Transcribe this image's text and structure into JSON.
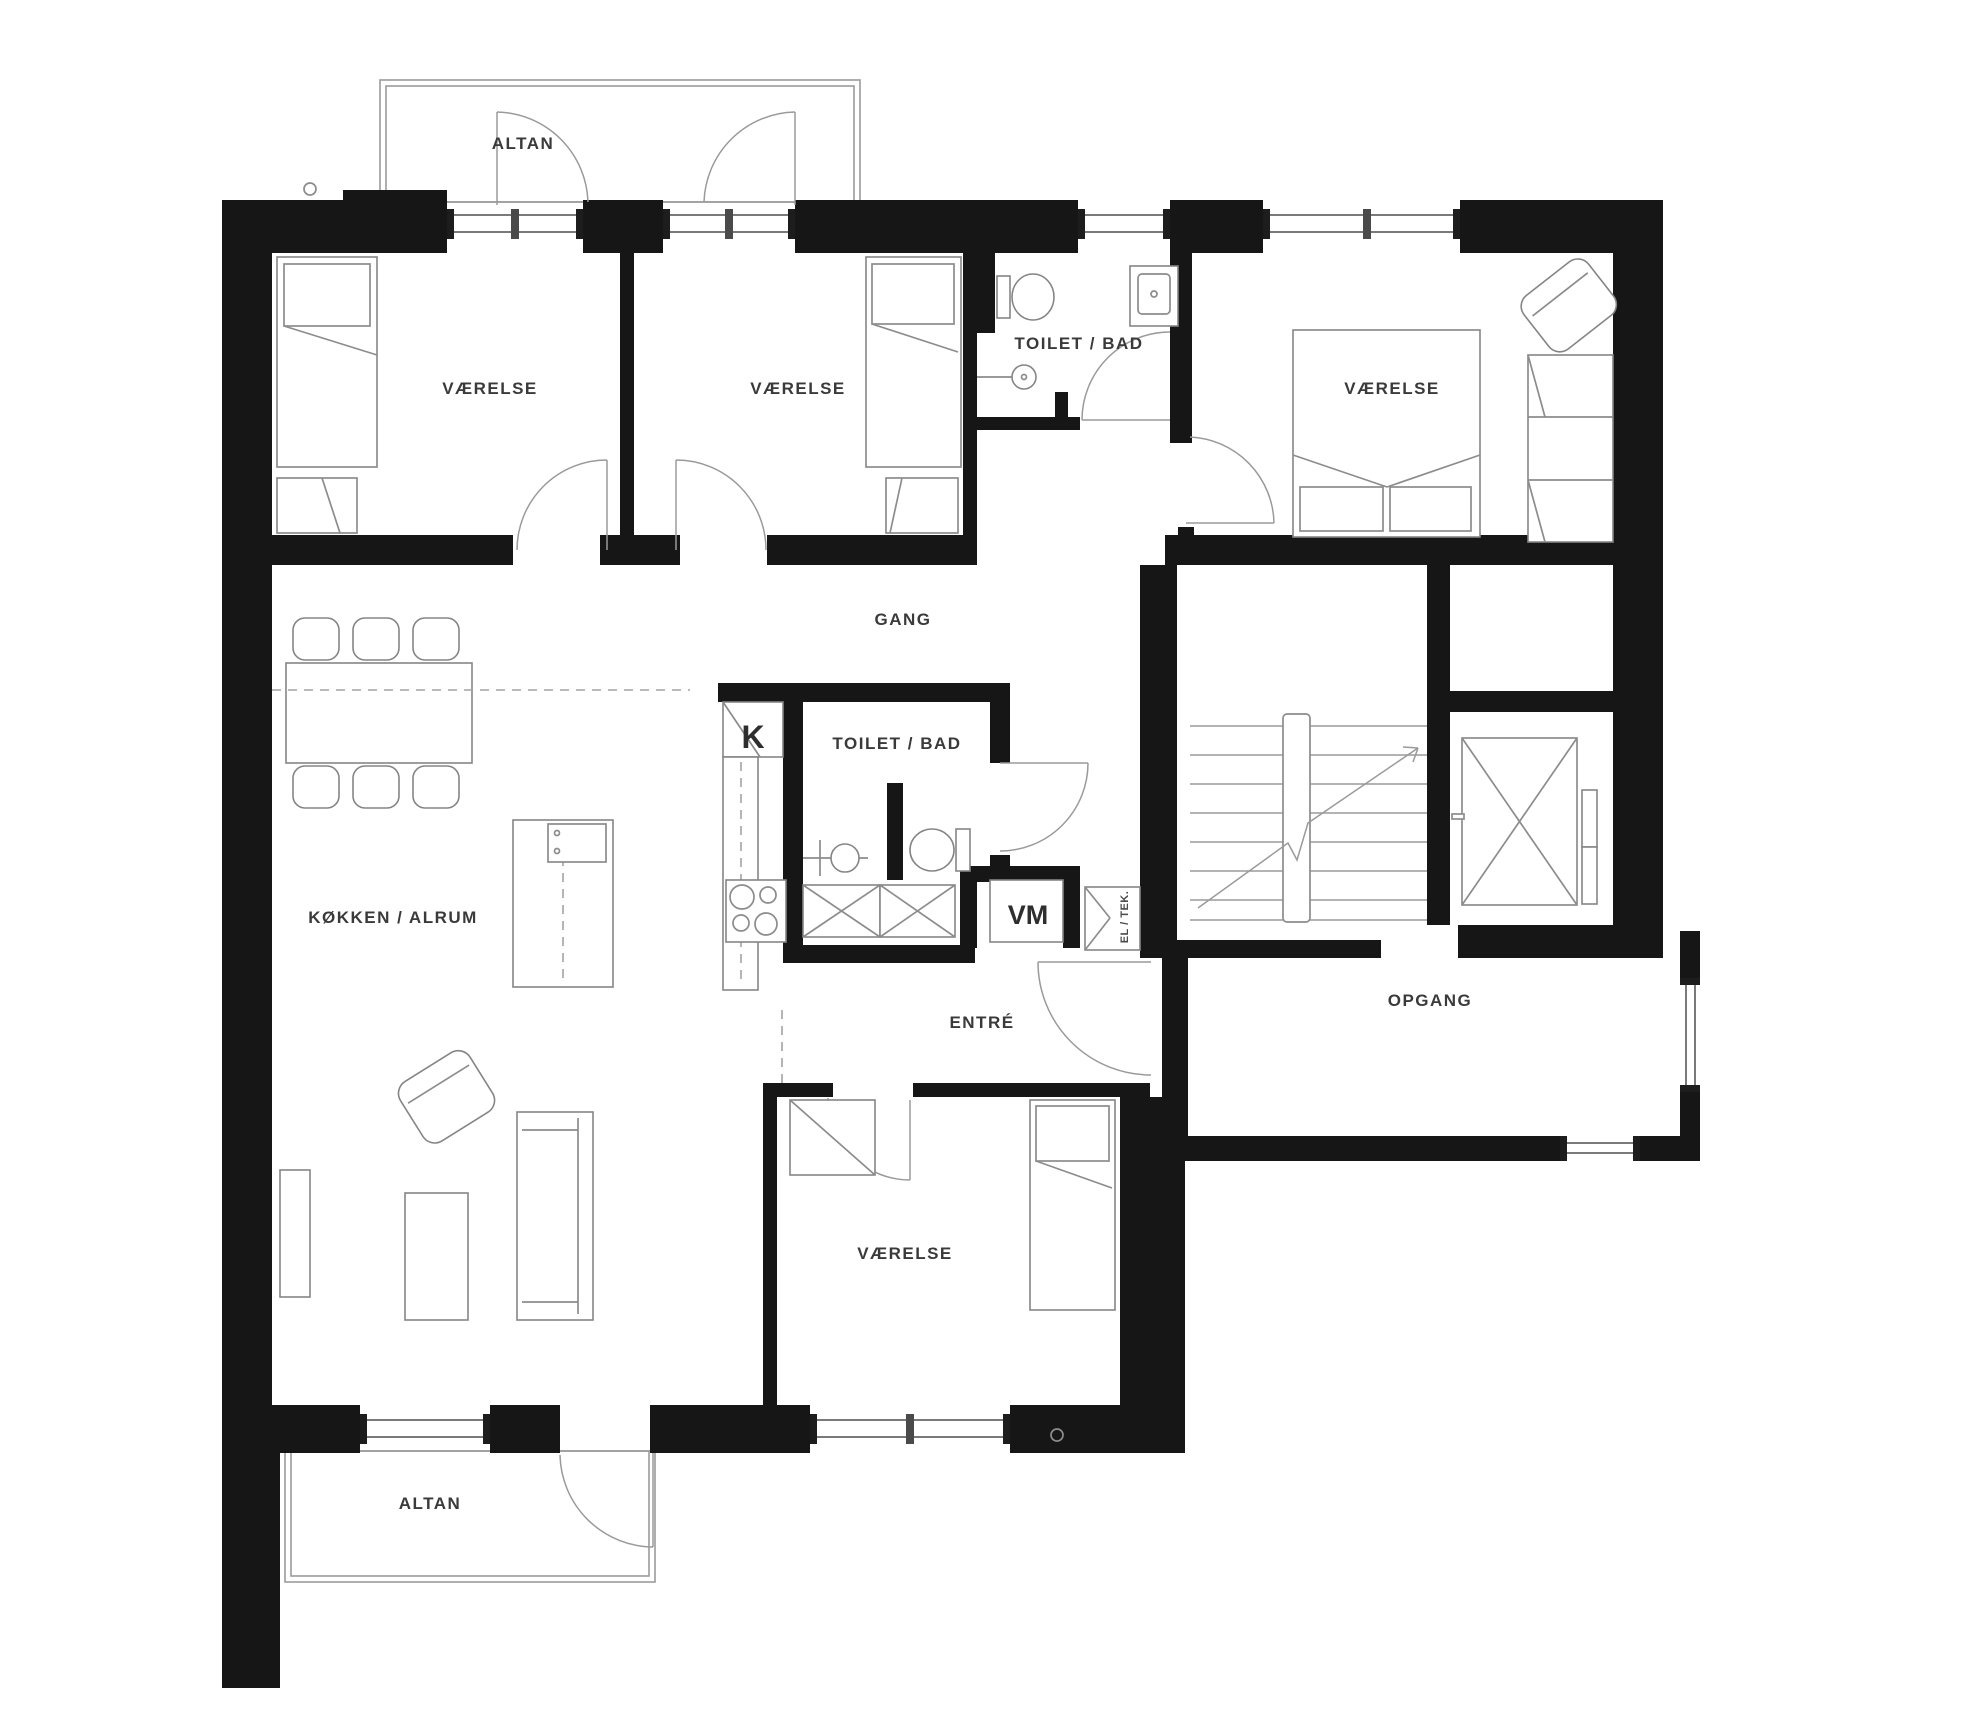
{
  "page": {
    "background": "#ffffff",
    "drawing_type": "apartment floor plan",
    "language": "Danish"
  },
  "plan": {
    "colors": {
      "wall": "#161616",
      "furniture_line": "#8c8c8c",
      "door_arc": "#9a9a9a",
      "label_text": "#3a3a3a",
      "background": "#ffffff"
    },
    "room_labels": [
      {
        "id": "balcony-top",
        "text": "ALTAN",
        "x": 523,
        "y": 149
      },
      {
        "id": "bedroom-1",
        "text": "VÆRELSE",
        "x": 490,
        "y": 394
      },
      {
        "id": "bedroom-2",
        "text": "VÆRELSE",
        "x": 798,
        "y": 394
      },
      {
        "id": "bathroom-top",
        "text": "TOILET / BAD",
        "x": 1079,
        "y": 349
      },
      {
        "id": "bedroom-3",
        "text": "VÆRELSE",
        "x": 1392,
        "y": 394
      },
      {
        "id": "hallway",
        "text": "GANG",
        "x": 903,
        "y": 625
      },
      {
        "id": "bathroom-mid",
        "text": "TOILET / BAD",
        "x": 897,
        "y": 749
      },
      {
        "id": "fridge",
        "text": "K",
        "x": 753,
        "y": 748
      },
      {
        "id": "kitchen-living",
        "text": "KØKKEN / ALRUM",
        "x": 393,
        "y": 923
      },
      {
        "id": "washing-machine",
        "text": "VM",
        "x": 1028,
        "y": 924
      },
      {
        "id": "el-tech",
        "text": "EL / TEK.",
        "x": 1124,
        "y": 917
      },
      {
        "id": "entry",
        "text": "ENTRÉ",
        "x": 982,
        "y": 1028
      },
      {
        "id": "stairwell-corridor",
        "text": "OPGANG",
        "x": 1430,
        "y": 1006
      },
      {
        "id": "bedroom-4",
        "text": "VÆRELSE",
        "x": 905,
        "y": 1259
      },
      {
        "id": "balcony-bottom",
        "text": "ALTAN",
        "x": 430,
        "y": 1509
      }
    ]
  }
}
